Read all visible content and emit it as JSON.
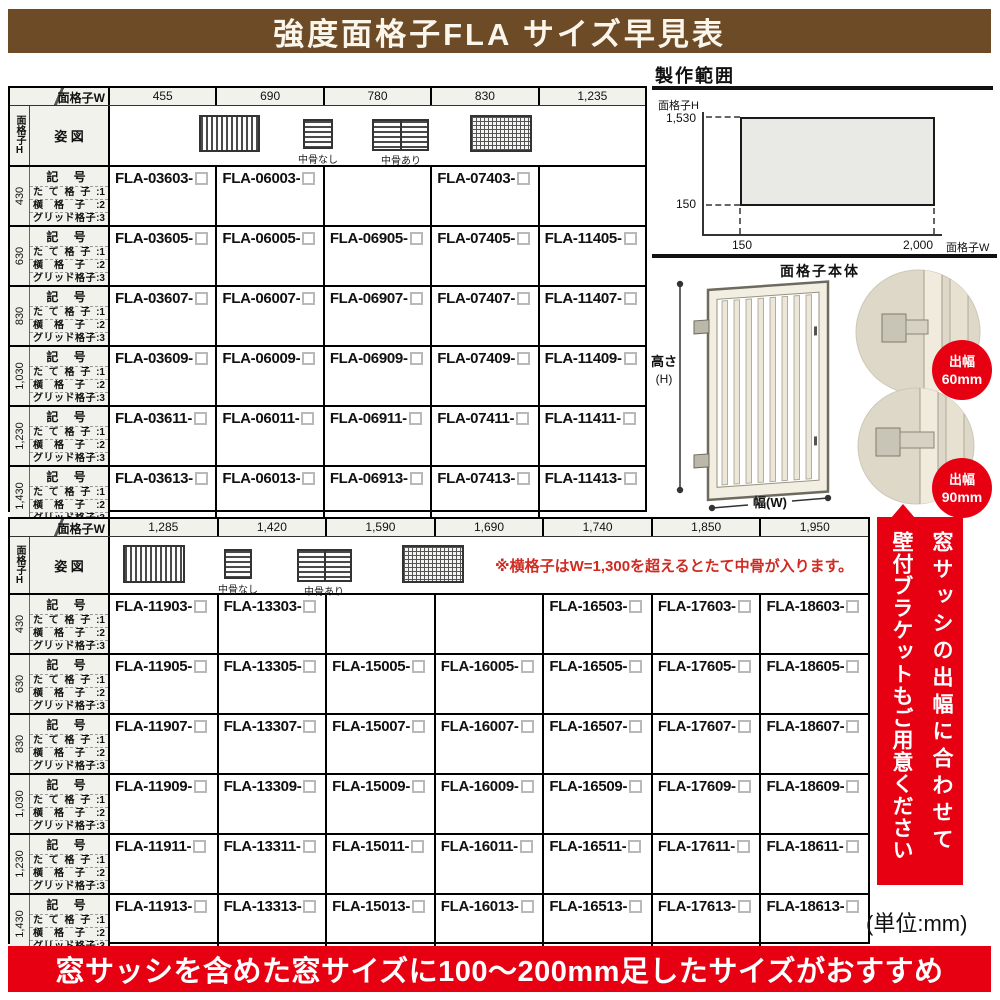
{
  "title_banner": {
    "text": "強度面格子FLA サイズ早見表",
    "bg": "#6d4b27"
  },
  "colors": {
    "accent_red": "#e60012",
    "banner_brown": "#6d4b27",
    "label_bg": "#f2f2ec",
    "note_red": "#d02b22"
  },
  "corner": {
    "col_axis": "面格子W",
    "row_axis": "面格子H"
  },
  "row_labels": {
    "code": "記 号",
    "types": [
      "たて格子:1",
      "横格子:2",
      "グリッド格子:3"
    ],
    "shape": "姿 図"
  },
  "legend": {
    "no_mid": "中骨なし",
    "with_mid": "中骨あり"
  },
  "table1": {
    "widths": [
      "455",
      "690",
      "780",
      "830",
      "1,235"
    ],
    "groups": [
      {
        "height": "430",
        "codes": [
          "FLA-03603-",
          "FLA-06003-",
          "",
          "FLA-07403-",
          ""
        ]
      },
      {
        "height": "630",
        "codes": [
          "FLA-03605-",
          "FLA-06005-",
          "FLA-06905-",
          "FLA-07405-",
          "FLA-11405-"
        ]
      },
      {
        "height": "830",
        "codes": [
          "FLA-03607-",
          "FLA-06007-",
          "FLA-06907-",
          "FLA-07407-",
          "FLA-11407-"
        ]
      },
      {
        "height": "1,030",
        "codes": [
          "FLA-03609-",
          "FLA-06009-",
          "FLA-06909-",
          "FLA-07409-",
          "FLA-11409-"
        ]
      },
      {
        "height": "1,230",
        "codes": [
          "FLA-03611-",
          "FLA-06011-",
          "FLA-06911-",
          "FLA-07411-",
          "FLA-11411-"
        ]
      },
      {
        "height": "1,430",
        "codes": [
          "FLA-03613-",
          "FLA-06013-",
          "FLA-06913-",
          "FLA-07413-",
          "FLA-11413-"
        ]
      }
    ]
  },
  "table2": {
    "widths": [
      "1,285",
      "1,420",
      "1,590",
      "1,690",
      "1,740",
      "1,850",
      "1,950"
    ],
    "note": "※横格子はW=1,300を超えるとたて中骨が入ります。",
    "groups": [
      {
        "height": "430",
        "codes": [
          "FLA-11903-",
          "FLA-13303-",
          "",
          "",
          "FLA-16503-",
          "FLA-17603-",
          "FLA-18603-"
        ]
      },
      {
        "height": "630",
        "codes": [
          "FLA-11905-",
          "FLA-13305-",
          "FLA-15005-",
          "FLA-16005-",
          "FLA-16505-",
          "FLA-17605-",
          "FLA-18605-"
        ]
      },
      {
        "height": "830",
        "codes": [
          "FLA-11907-",
          "FLA-13307-",
          "FLA-15007-",
          "FLA-16007-",
          "FLA-16507-",
          "FLA-17607-",
          "FLA-18607-"
        ]
      },
      {
        "height": "1,030",
        "codes": [
          "FLA-11909-",
          "FLA-13309-",
          "FLA-15009-",
          "FLA-16009-",
          "FLA-16509-",
          "FLA-17609-",
          "FLA-18609-"
        ]
      },
      {
        "height": "1,230",
        "codes": [
          "FLA-11911-",
          "FLA-13311-",
          "FLA-15011-",
          "FLA-16011-",
          "FLA-16511-",
          "FLA-17611-",
          "FLA-18611-"
        ]
      },
      {
        "height": "1,430",
        "codes": [
          "FLA-11913-",
          "FLA-13313-",
          "FLA-15013-",
          "FLA-16013-",
          "FLA-16513-",
          "FLA-17613-",
          "FLA-18613-"
        ]
      }
    ]
  },
  "production_range": {
    "title": "製作範囲",
    "y_axis": "面格子H",
    "x_axis": "面格子W",
    "y_max": "1,530",
    "y_min": "150",
    "x_min": "150",
    "x_max": "2,000"
  },
  "illustration": {
    "body_label": "面格子本体",
    "height_label": "高さ",
    "height_sub": "(H)",
    "width_label": "幅(W)",
    "callouts": [
      {
        "line1": "出幅",
        "line2": "60mm"
      },
      {
        "line1": "出幅",
        "line2": "90mm"
      }
    ]
  },
  "side_banner": {
    "line1": "窓サッシの出幅に合わせて",
    "line2": "壁付ブラケットもご用意ください"
  },
  "unit_note": "(単位:mm)",
  "bottom_banner": {
    "text": "窓サッシを含めた窓サイズに100〜200mm足したサイズがおすすめ"
  }
}
